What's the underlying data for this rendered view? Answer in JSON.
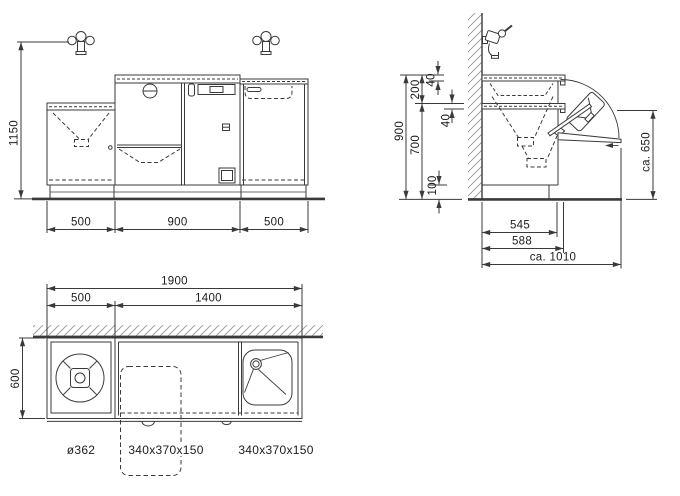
{
  "drawing": {
    "type": "technical installation drawing, three orthographic views",
    "colors": {
      "background": "#ffffff",
      "line": "#3a3a3a",
      "hatch": "#8f8f8f",
      "text": "#1c1c1c"
    }
  },
  "front_view": {
    "dim_height_to_tap": "1150",
    "dim_width_left": "500",
    "dim_width_middle": "900",
    "dim_width_right": "500"
  },
  "side_view": {
    "dim_total_height": "900",
    "dim_lower_height": "700",
    "dim_upper_height": "200",
    "dim_counter_thickness": "40",
    "dim_shelf_thickness": "40",
    "dim_plinth_height": "100",
    "dim_depth_body": "545",
    "dim_depth_counter": "588",
    "dim_depth_open": "ca. 1010",
    "dim_open_height": "ca. 650"
  },
  "plan_view": {
    "dim_total_width": "1900",
    "dim_width_left": "500",
    "dim_width_right": "1400",
    "dim_depth": "600",
    "label_round_basin": "ø362",
    "label_tipout_basin": "340x370x150",
    "label_sink": "340x370x150"
  }
}
